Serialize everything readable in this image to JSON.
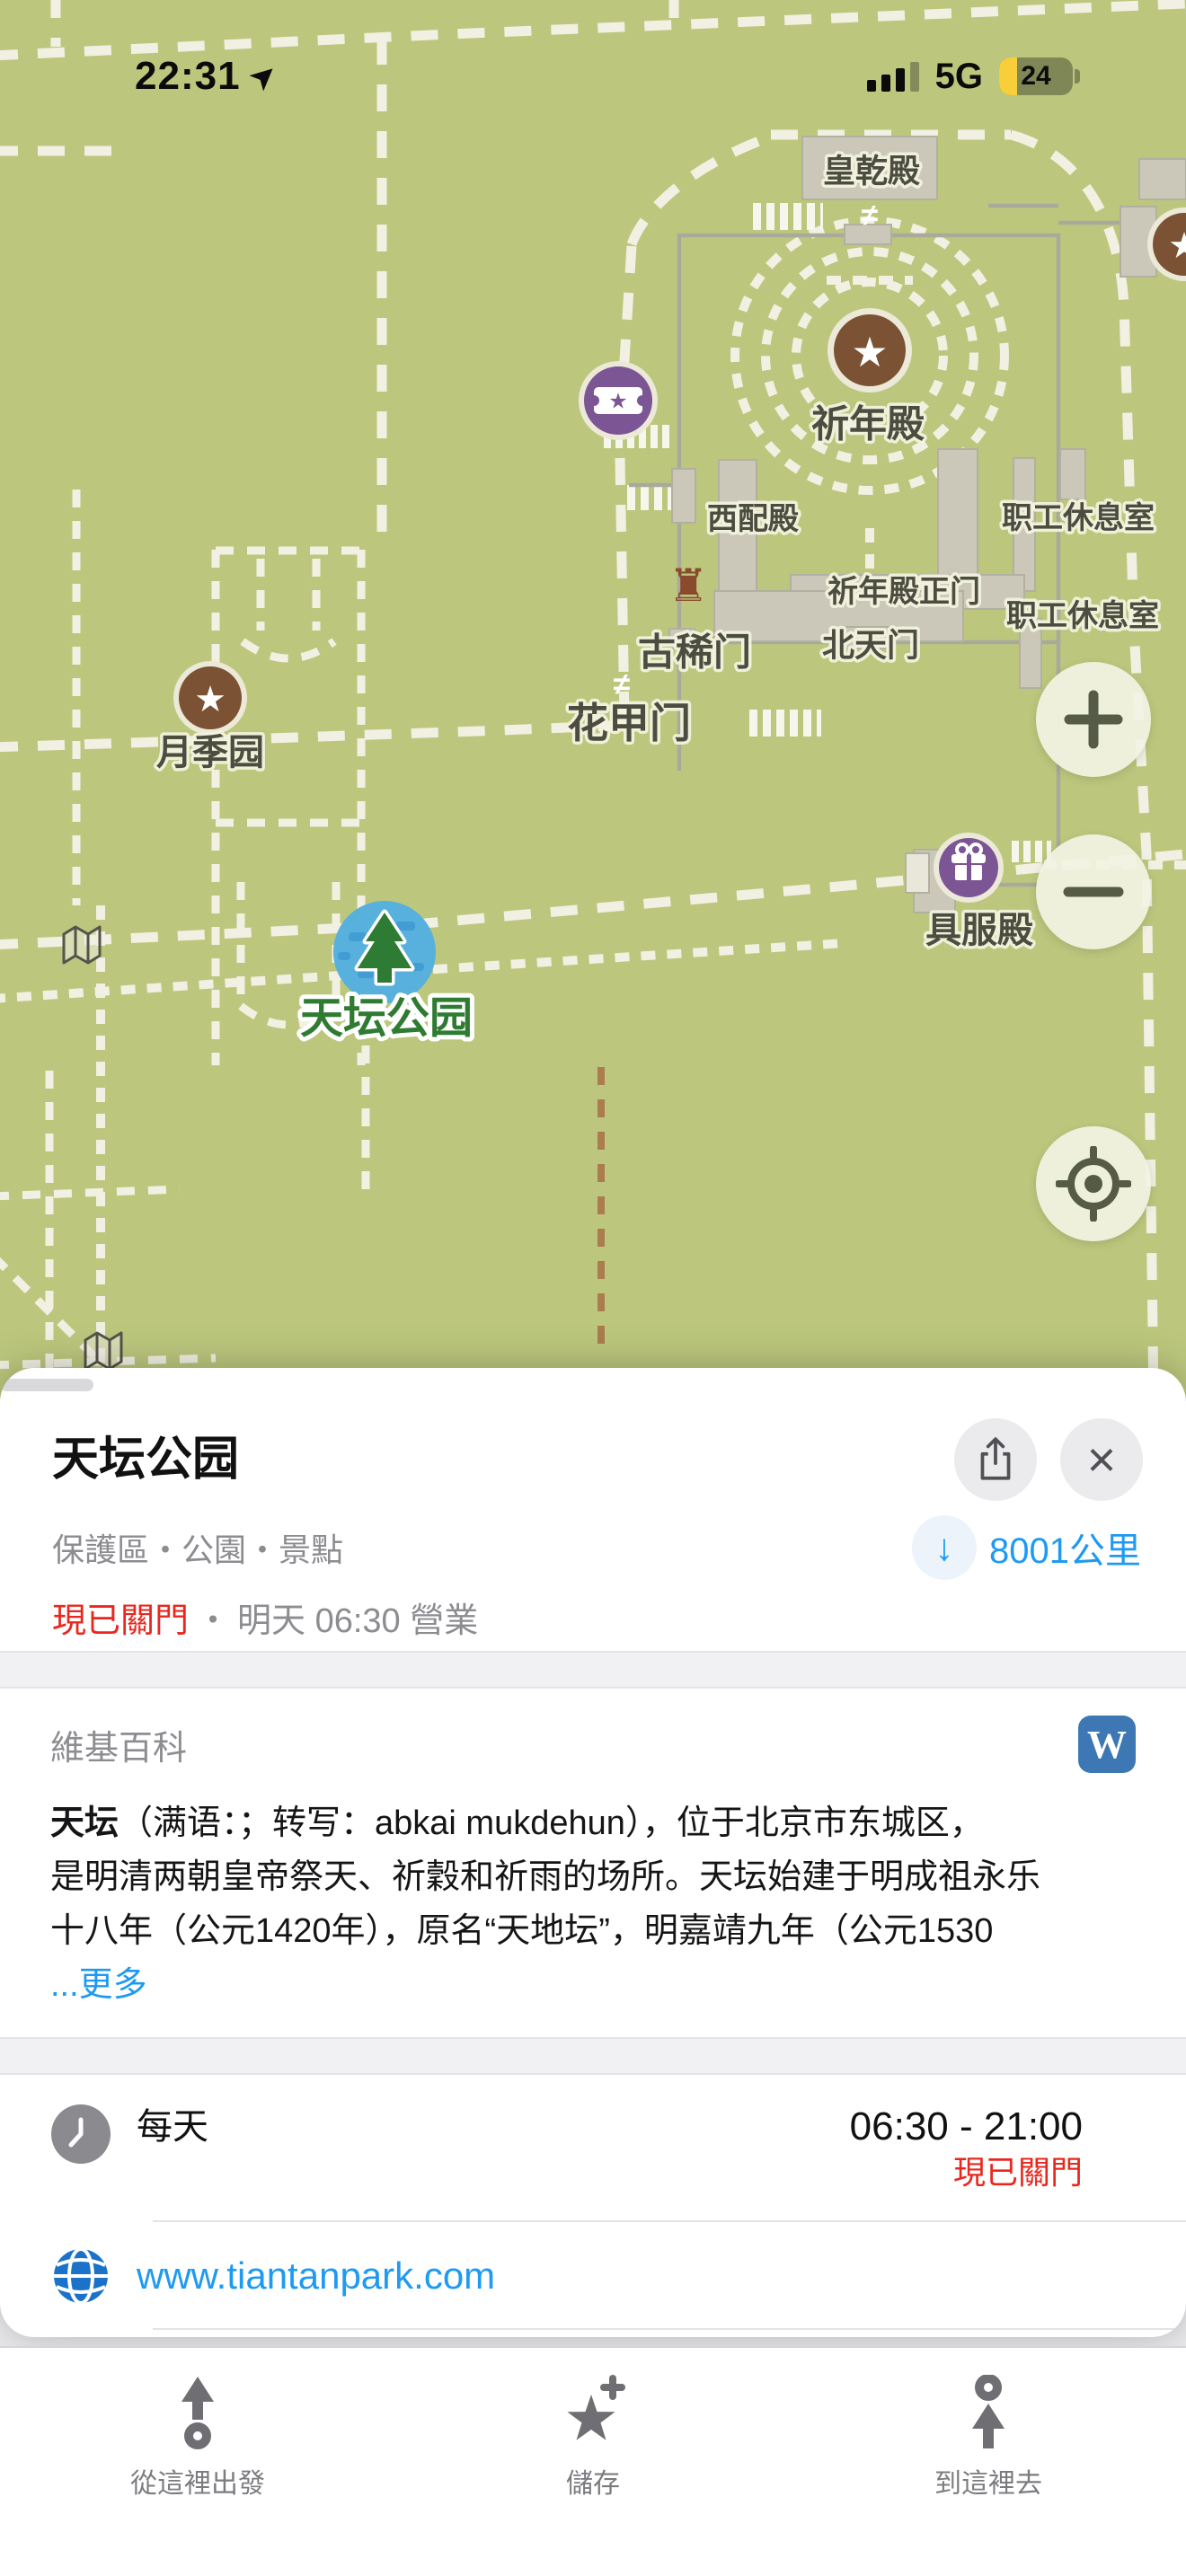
{
  "colors": {
    "map_bg": "#bcc77d",
    "path_cream": "#f1f0e2",
    "green_label": "#2e7b31",
    "accent_blue": "#1e9af2",
    "closed_red": "#e8281e",
    "wiki_blue": "#3d78b4",
    "battery_yellow": "#f8ce3a",
    "purple_poi": "#7c5694",
    "brown_poi": "#7b5233",
    "marker_blue": "#58b0dd",
    "tree_green": "#2e7b33"
  },
  "status_bar": {
    "time": "22:31",
    "network": "5G",
    "battery_level": "24"
  },
  "map": {
    "star_glyph": "★",
    "castle_glyph": "♜",
    "gate_glyph": "≠",
    "labels": [
      {
        "text": "皇乾殿"
      },
      {
        "text": "祈年殿"
      },
      {
        "text": "西配殿"
      },
      {
        "text": "职工休息室"
      },
      {
        "text": "祈年殿正门"
      },
      {
        "text": "职工休息室"
      },
      {
        "text": "古稀门"
      },
      {
        "text": "北天门"
      },
      {
        "text": "花甲门"
      },
      {
        "text": "月季园"
      },
      {
        "text": "具服殿"
      },
      {
        "text": "天坛公园"
      }
    ],
    "controls": {
      "zoom_in": "+",
      "zoom_out": "−"
    }
  },
  "sheet": {
    "title": "天坛公园",
    "close_glyph": "×",
    "categories": "保護區・公園・景點",
    "distance_arrow": "↓",
    "distance": "8001公里",
    "closed_status": "現已關門",
    "separator": "・",
    "open_info": "明天 06:30 營業",
    "wikipedia": {
      "header": "維基百科",
      "icon_letter": "W",
      "lead": "天坛",
      "line1": "（满语：；转写：abkai mukdehun），位于北京市东城区，",
      "line2": "是明清两朝皇帝祭天、祈穀和祈雨的场所。天坛始建于明成祖永乐",
      "line3": "十八年（公元1420年），原名“天地坛”，明嘉靖九年（公元1530",
      "more": "...更多"
    },
    "hours": {
      "days": "每天",
      "time": "06:30 - 21:00",
      "status": "現已關門"
    },
    "website": "www.tiantanpark.com"
  },
  "action_bar": {
    "items": [
      {
        "label": "從這裡出發"
      },
      {
        "label": "儲存"
      },
      {
        "label": "到這裡去"
      }
    ]
  }
}
